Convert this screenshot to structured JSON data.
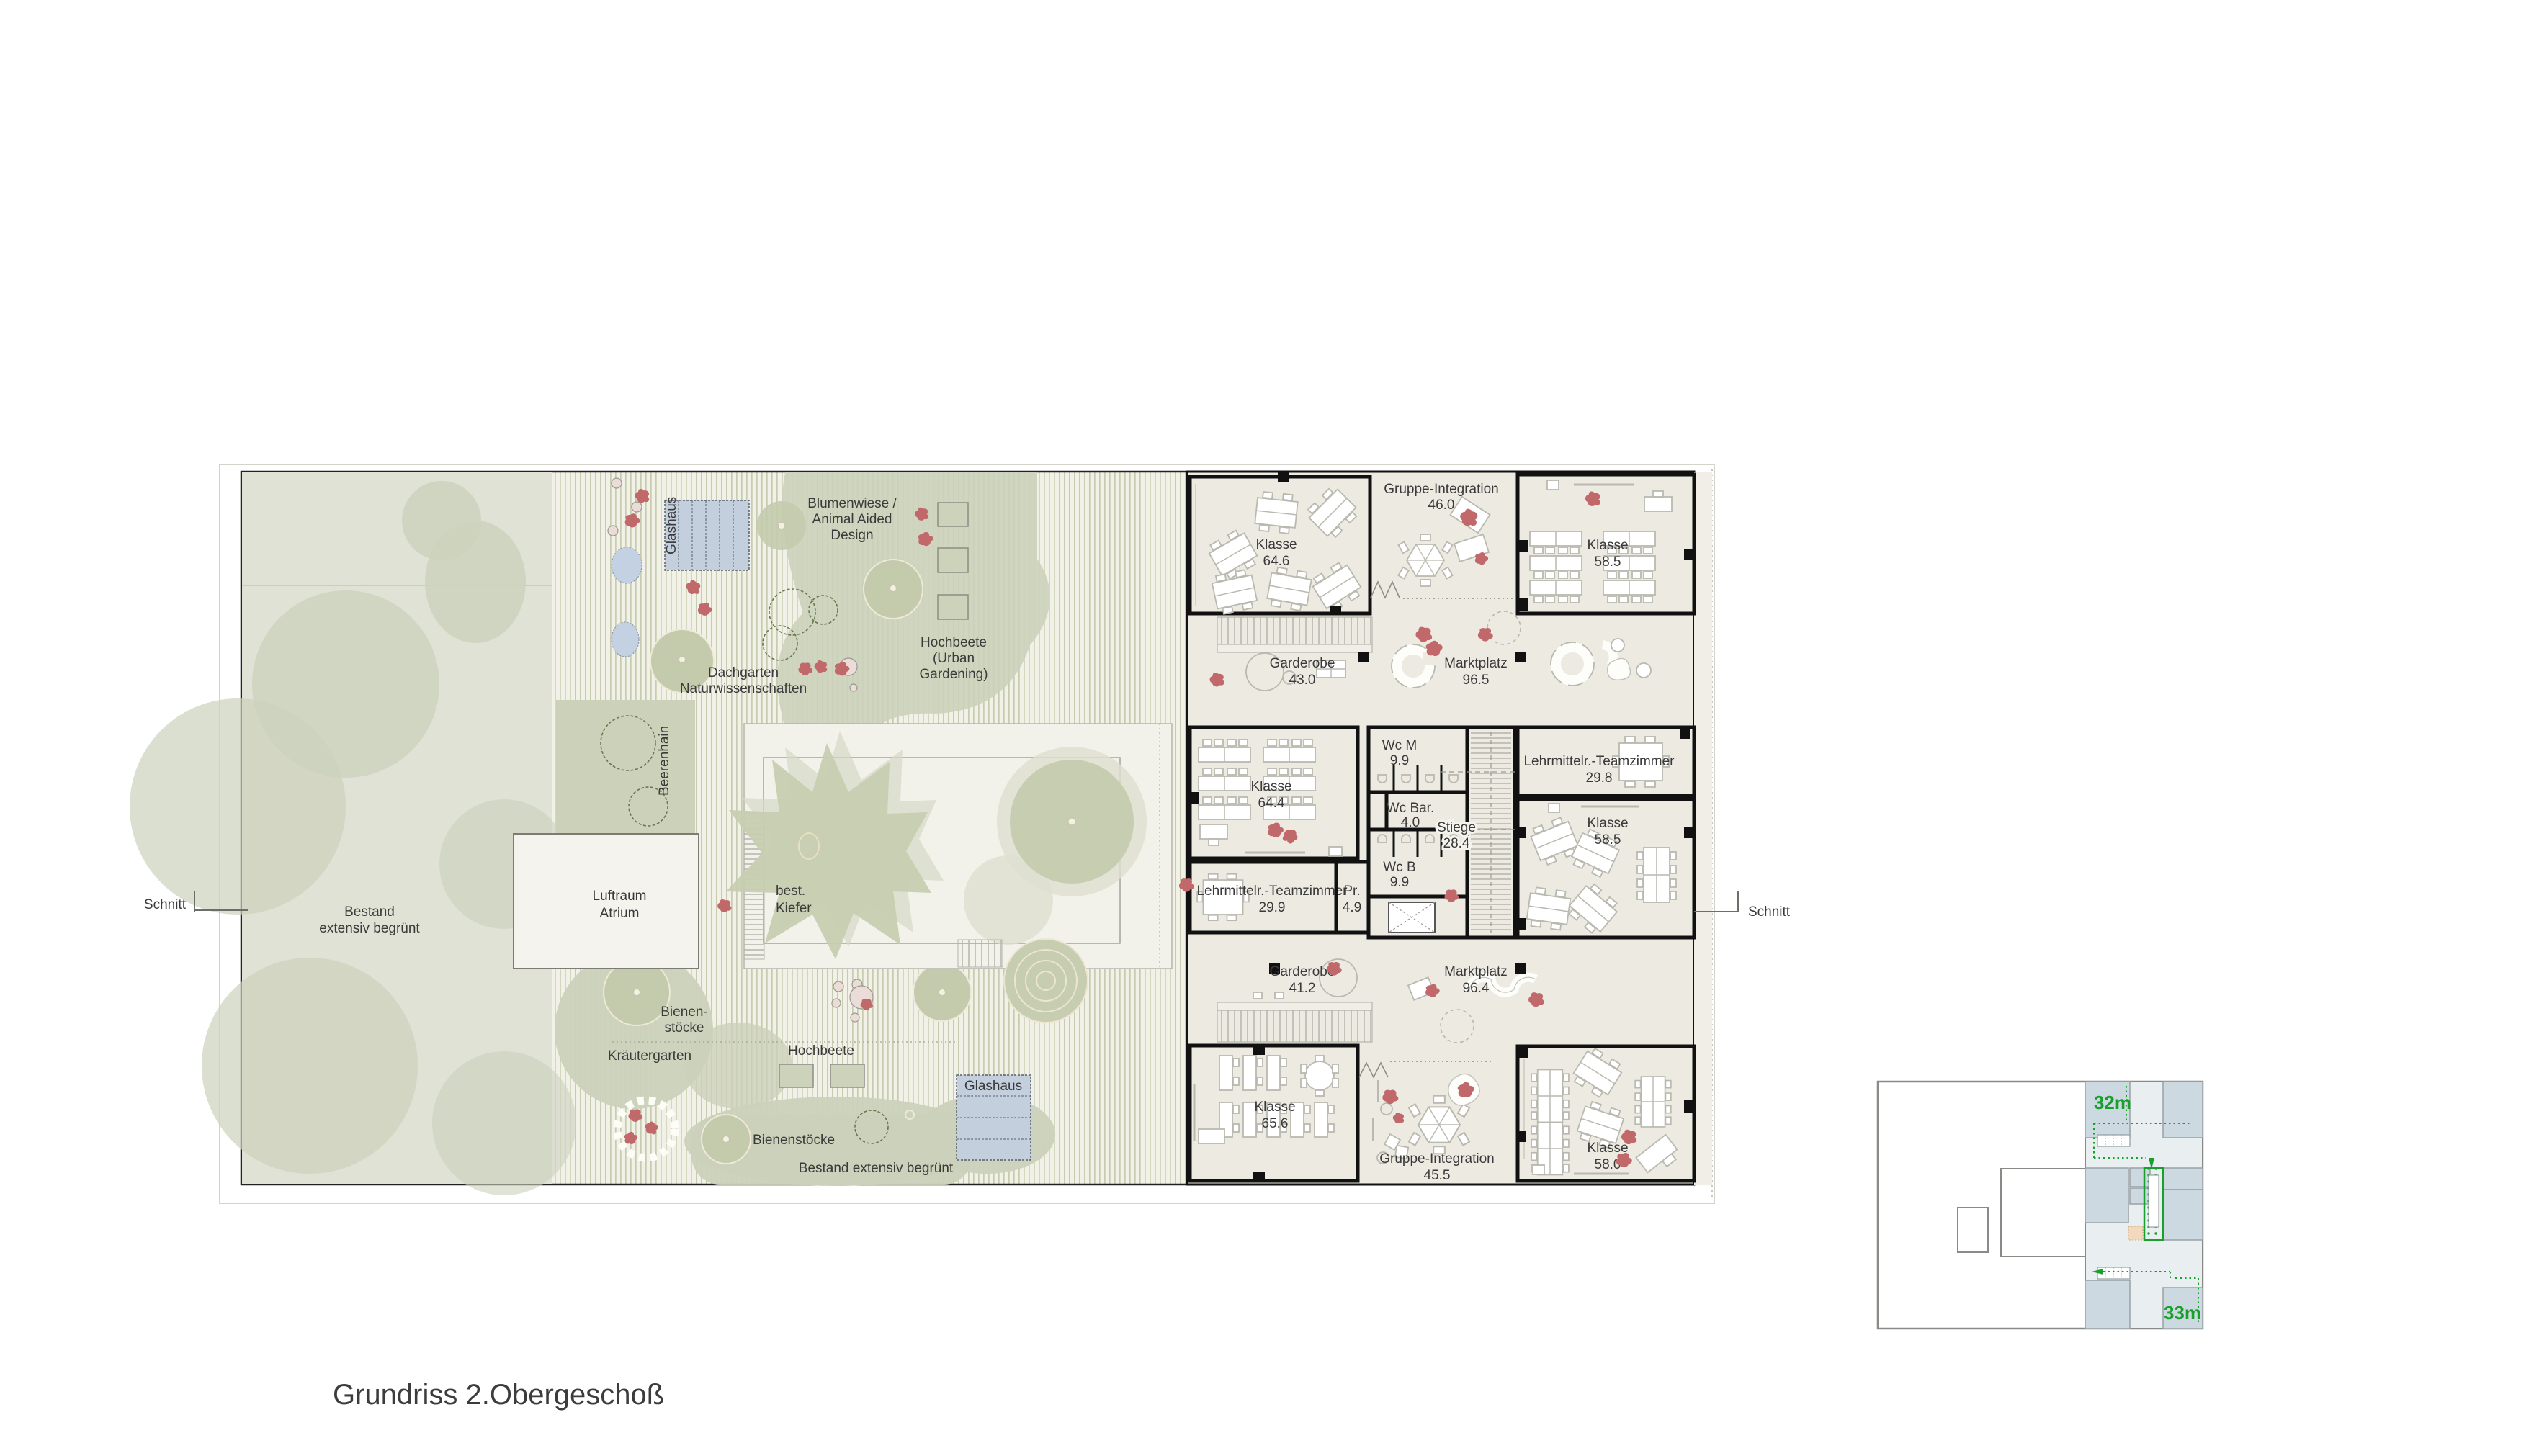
{
  "title": "Grundriss 2.Obergeschoß",
  "section": {
    "left_label": "Schnitt",
    "right_label": "Schnitt"
  },
  "garden": {
    "glashaus_top": "Glashaus",
    "glashaus_bottom": "Glashaus",
    "blumenwiese": [
      "Blumenwiese /",
      "Animal Aided",
      "Design"
    ],
    "hochbeete_urban": [
      "Hochbeete",
      "(Urban",
      "Gardening)"
    ],
    "dachgarten": [
      "Dachgarten",
      "Naturwissenschaften"
    ],
    "beerenhain": "Beerenhain",
    "luftraum": [
      "Luftraum",
      "Atrium"
    ],
    "kiefer": [
      "best.",
      "Kiefer"
    ],
    "bestand_left": [
      "Bestand",
      "extensiv begrünt"
    ],
    "bienen_split": [
      "Bienen-",
      "stöcke"
    ],
    "kraeutergarten": "Kräutergarten",
    "hochbeete": "Hochbeete",
    "bienenstoecke": "Bienenstöcke",
    "bestand_bottom": "Bestand extensiv begrünt"
  },
  "rooms": {
    "klasse_646": {
      "name": "Klasse",
      "area": "64.6"
    },
    "gruppe_integration_46": {
      "name": "Gruppe-Integration",
      "area": "46.0"
    },
    "klasse_585_top": {
      "name": "Klasse",
      "area": "58.5"
    },
    "garderobe_43": {
      "name": "Garderobe",
      "area": "43.0"
    },
    "marktplatz_965": {
      "name": "Marktplatz",
      "area": "96.5"
    },
    "klasse_644": {
      "name": "Klasse",
      "area": "64.4"
    },
    "wc_m": {
      "name": "Wc M",
      "area": "9.9"
    },
    "wc_bar": {
      "name": "Wc Bar.",
      "area": "4.0"
    },
    "stiege": {
      "name": "Stiege",
      "area": "28.4"
    },
    "lehrmittel_298": {
      "name": "Lehrmittelr.-Teamzimmer",
      "area": "29.8"
    },
    "klasse_585_mid": {
      "name": "Klasse",
      "area": "58.5"
    },
    "lehrmittel_299": {
      "name": "Lehrmittelr.-Teamzimmer",
      "area": "29.9"
    },
    "pr": {
      "name": "Pr.",
      "area": "4.9"
    },
    "wc_b": {
      "name": "Wc B",
      "area": "9.9"
    },
    "garderobe_412": {
      "name": "Garderobe",
      "area": "41.2"
    },
    "marktplatz_964": {
      "name": "Marktplatz",
      "area": "96.4"
    },
    "klasse_656": {
      "name": "Klasse",
      "area": "65.6"
    },
    "gruppe_integration_455": {
      "name": "Gruppe-Integration",
      "area": "45.5"
    },
    "klasse_580": {
      "name": "Klasse",
      "area": "58.0"
    }
  },
  "keyplan": {
    "dim_top": "32m",
    "dim_bottom": "33m"
  },
  "colors": {
    "accent_green": "#17a02b",
    "figure_red": "#c0686a",
    "meadow_sage": "#c8cfb2",
    "garden_base": "#f2f1e8",
    "left_block_green": "#dfe2d4",
    "corridor_beige": "#eceae1",
    "keyplan_room_blue": "#cdd9e0",
    "keyplan_light": "#e9eef1",
    "wall_black": "#111111",
    "glasshouse_blue": "#c3cfdd",
    "pond_blue": "#c4d1e2",
    "highlight_peach": "#f2d9bd"
  }
}
